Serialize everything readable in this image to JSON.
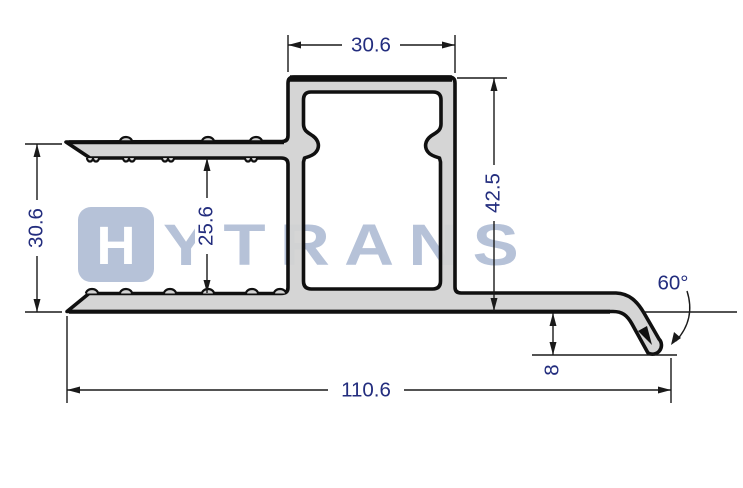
{
  "drawing": {
    "kind": "aluminum-extrusion-profile-cross-section",
    "watermark": {
      "tile_letter": "H",
      "brand_text": "YTRANS"
    },
    "dims": {
      "top_width": "30.6",
      "overall_height": "42.5",
      "left_height": "30.6",
      "flange_gap": "25.6",
      "overall_width": "110.6",
      "tip_drop": "8",
      "bend_angle": "60°"
    },
    "colors": {
      "profile_fill": "#d2d2d2",
      "outline": "#101010",
      "dimension_text": "#232d7e",
      "dimension_lines": "#1a1a1a",
      "watermark": "#b6c2d8",
      "background": "#ffffff"
    }
  }
}
